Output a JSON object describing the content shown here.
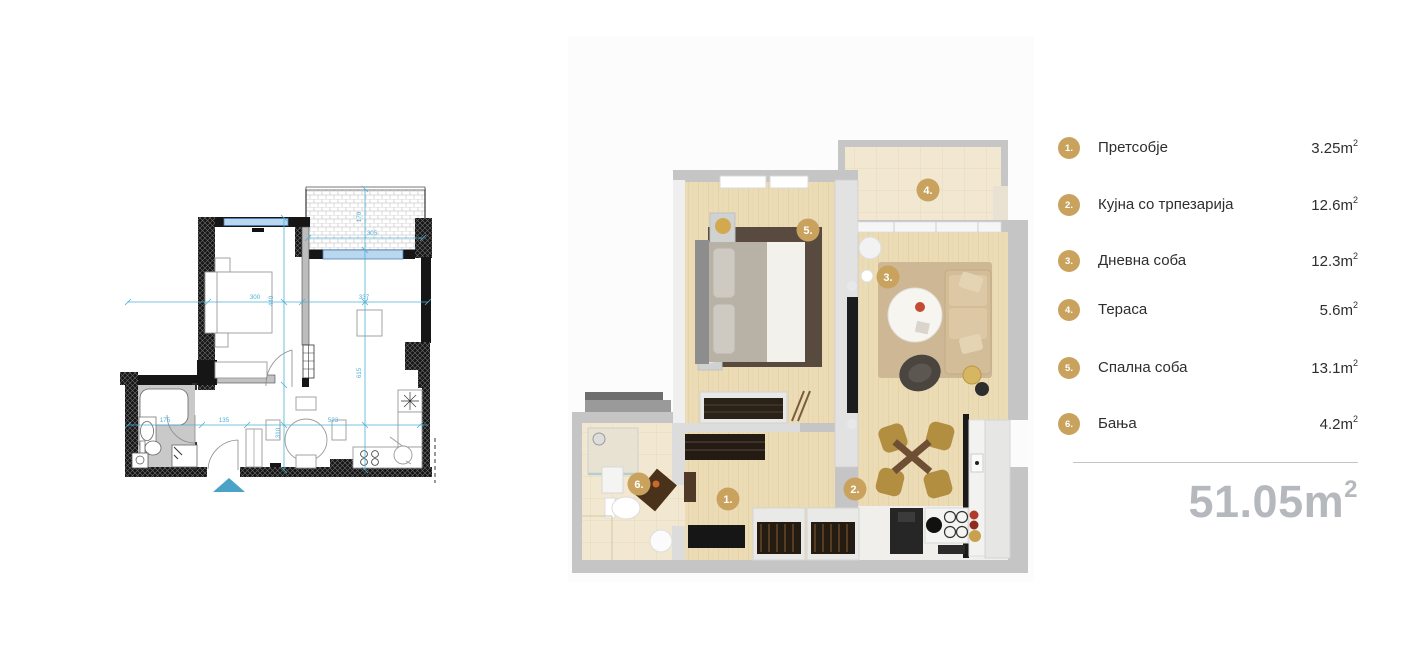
{
  "legend": {
    "badge_color": "#c9a35e",
    "items": [
      {
        "number": "1.",
        "label": "Претсобје",
        "area": "3.25"
      },
      {
        "number": "2.",
        "label": "Кујна со трпезарија",
        "area": "12.6"
      },
      {
        "number": "3.",
        "label": "Дневна соба",
        "area": "12.3"
      },
      {
        "number": "4.",
        "label": "Тераса",
        "area": "5.6"
      },
      {
        "number": "5.",
        "label": "Спална соба",
        "area": "13.1"
      },
      {
        "number": "6.",
        "label": "Бања",
        "area": "4.2"
      }
    ],
    "unit_base": "m",
    "unit_exponent": "2",
    "total": "51.05",
    "total_color": "#b5b8bd"
  },
  "plan3d": {
    "badges": [
      {
        "number": "1."
      },
      {
        "number": "2."
      },
      {
        "number": "3."
      },
      {
        "number": "4."
      },
      {
        "number": "5."
      },
      {
        "number": "6."
      }
    ]
  },
  "plan2d": {
    "dims": {
      "bedroom_width": "300",
      "living_width": "337",
      "bedroom_depth": "440",
      "living_depth": "615",
      "bath_width": "175",
      "hall_width": "135",
      "kitchen_width": "523",
      "hall_depth": "310",
      "terrace_width": "305",
      "terrace_depth": "170"
    },
    "colors": {
      "dimension": "#4fb0d5",
      "wall": "#161616",
      "window": "#b9d7ee",
      "entrance_arrow": "#4aa2c6"
    }
  }
}
